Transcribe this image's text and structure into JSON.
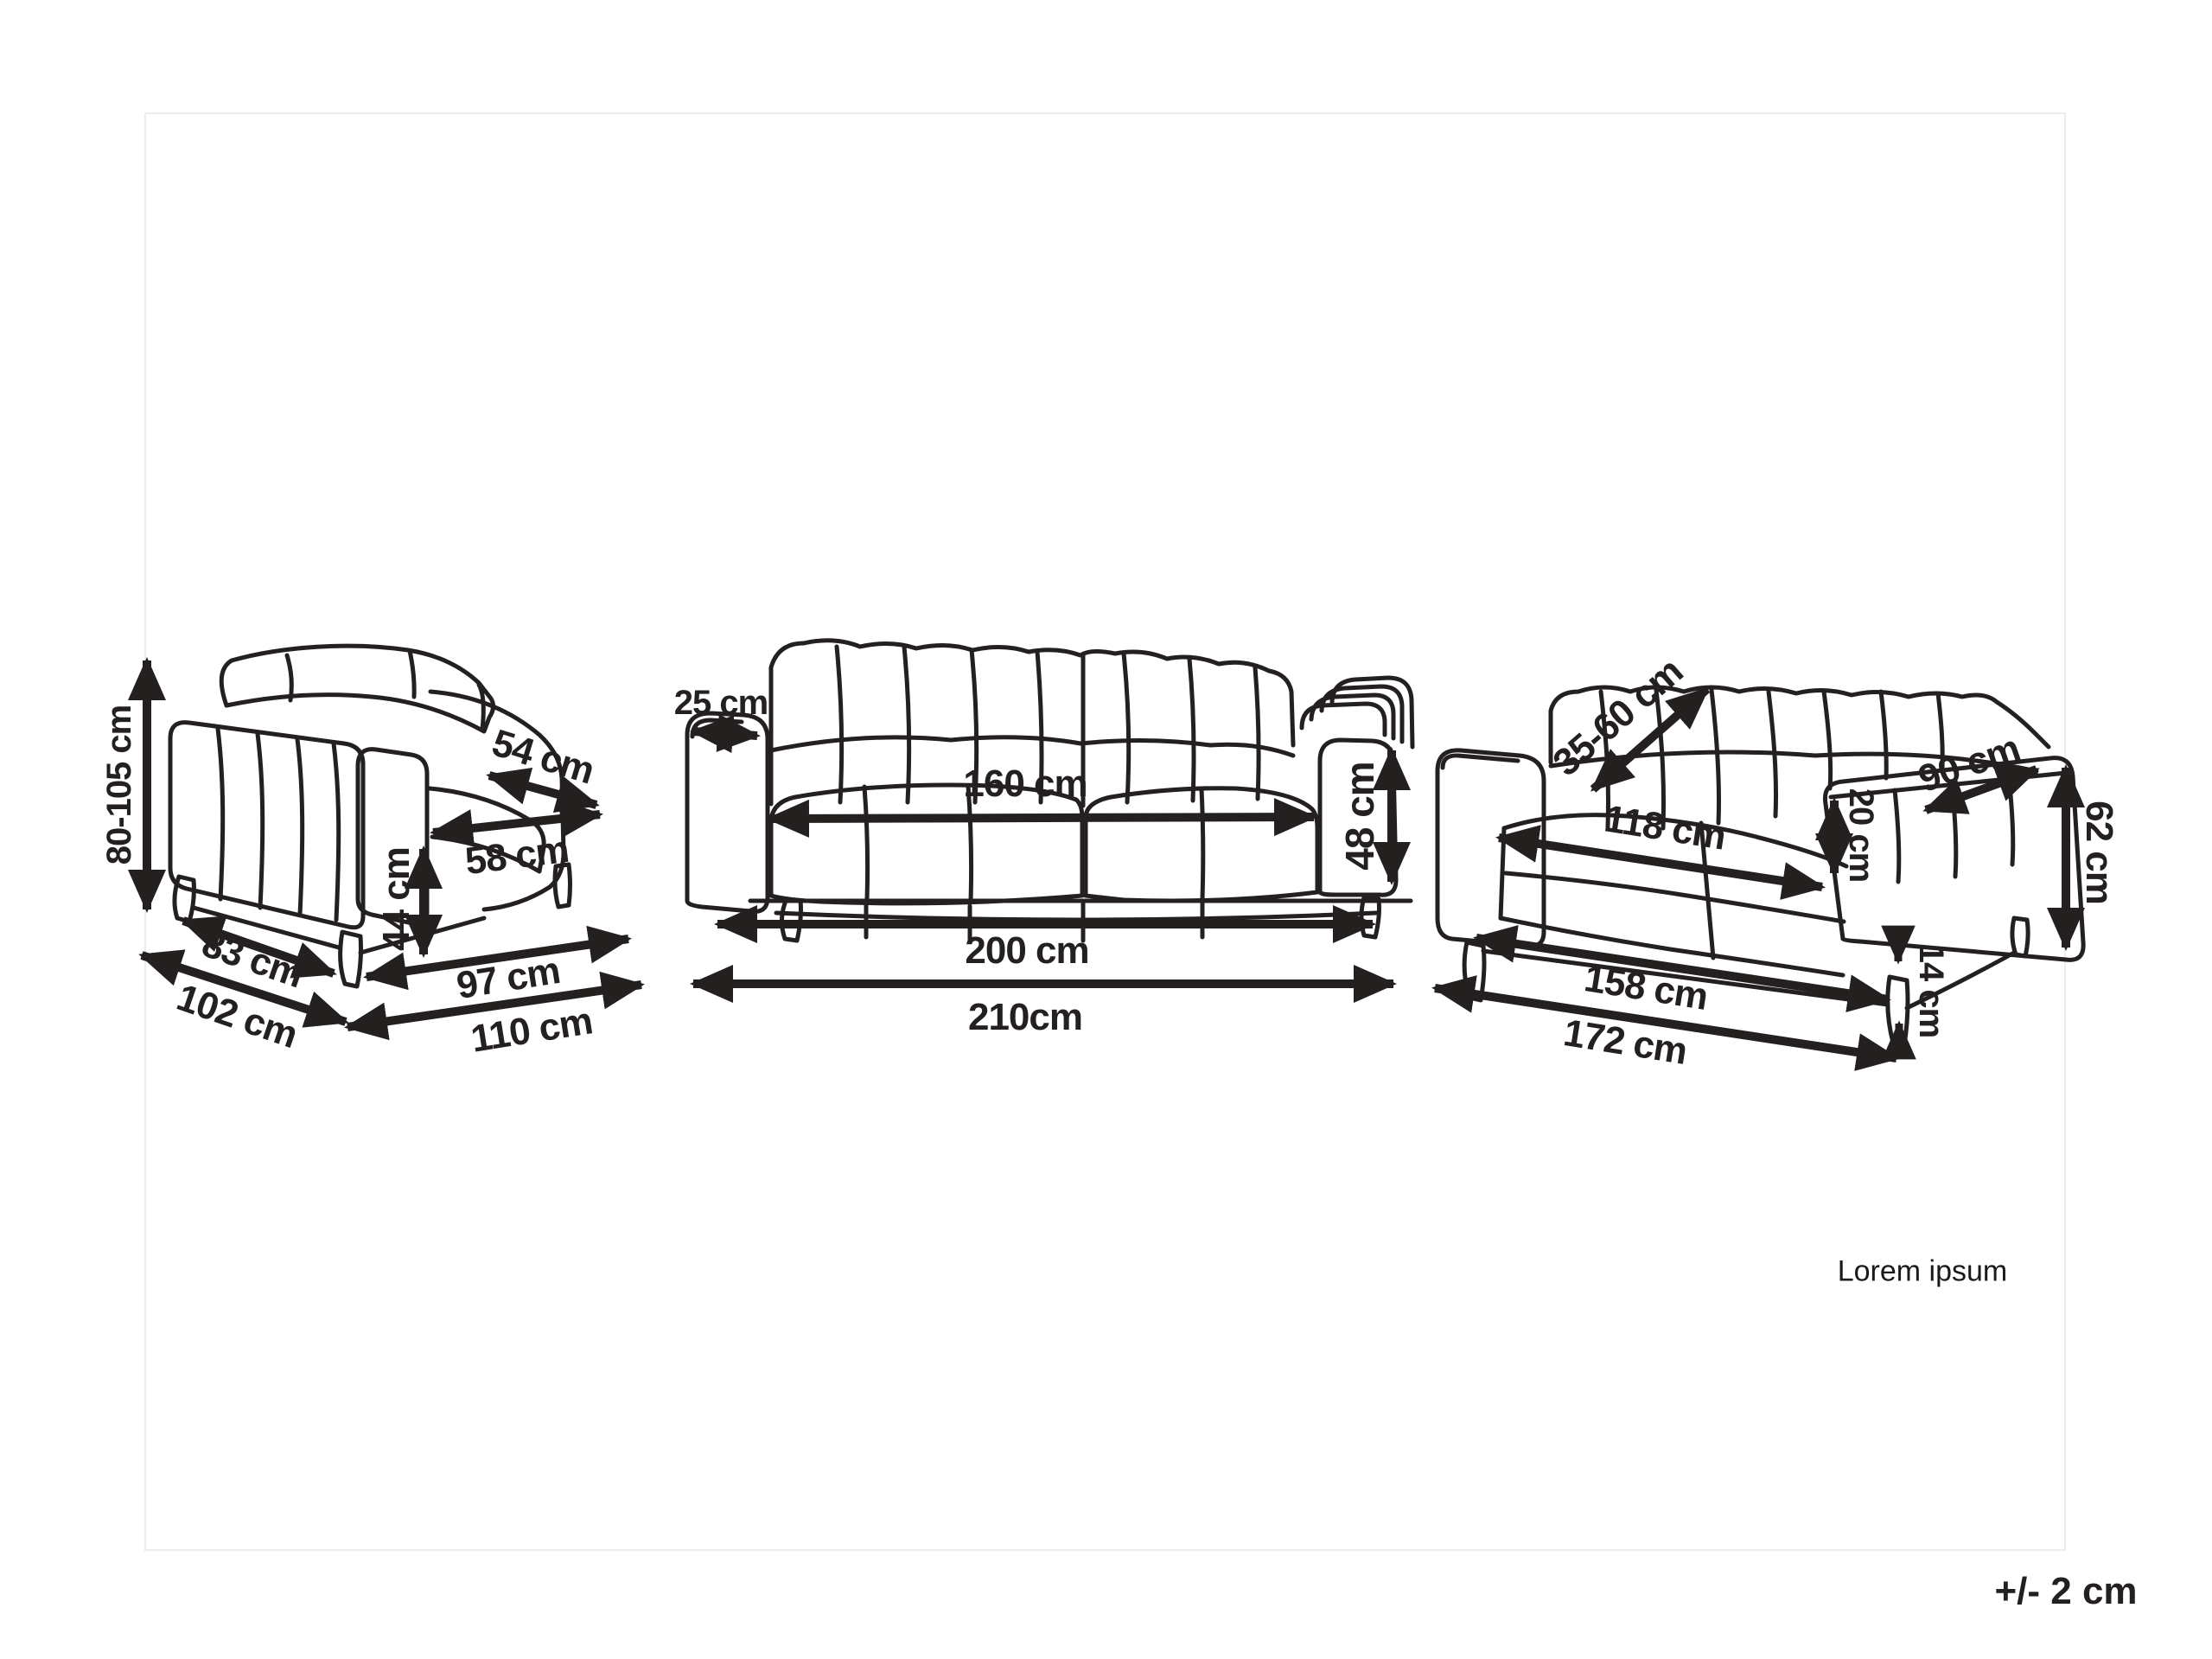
{
  "ink_color": "#242020",
  "frame_color": "#f1ecec",
  "notes": {
    "watermark": "Lorem ipsum",
    "tolerance": "+/- 2 cm"
  },
  "pieces": [
    {
      "name": "armchair",
      "dim_labels": [
        "80-105 cm",
        "54 cm",
        "58 cm",
        "44 cm",
        "83 cm",
        "102 cm",
        "97 cm",
        "110 cm"
      ]
    },
    {
      "name": "three-seater-sofa",
      "dim_labels": [
        "25 cm",
        "160 cm",
        "48 cm",
        "200 cm",
        "210cm"
      ]
    },
    {
      "name": "two-seater-sofa",
      "dim_labels": [
        "35-60 cm",
        "118 cm",
        "90 cm",
        "20 cm",
        "62 cm",
        "14 cm",
        "158 cm",
        "172 cm"
      ]
    }
  ]
}
